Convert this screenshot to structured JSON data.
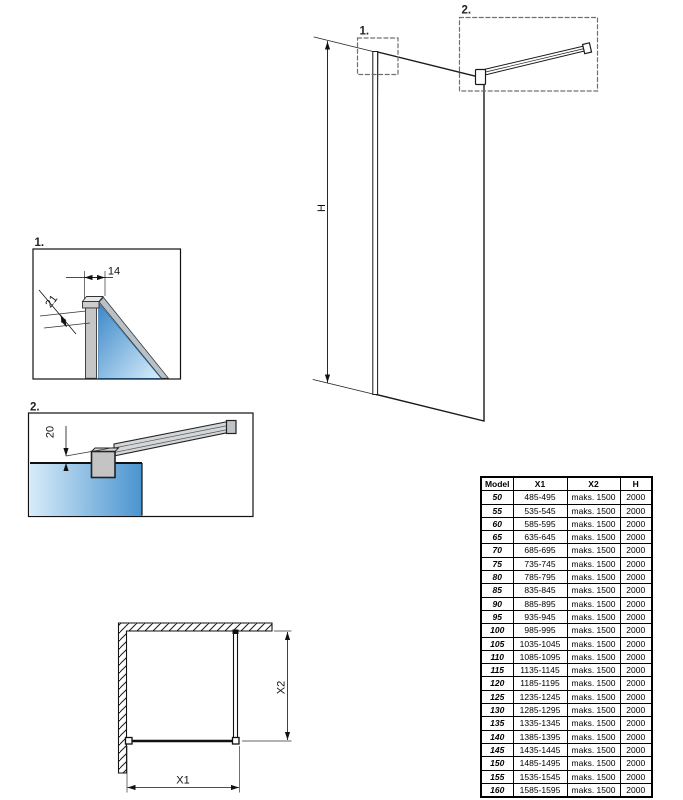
{
  "drawing": {
    "callout_1": "1.",
    "callout_2": "2.",
    "dim_height": "H",
    "dim_width": "X1",
    "dim_depth": "X2",
    "dim_profile_width": "14",
    "dim_profile_depth": "21",
    "dim_bar_offset": "20"
  },
  "colors": {
    "line": "#1a1a1a",
    "dash_gray": "#707070",
    "metal_gray": "#c6c6c6",
    "glass_blue_dark": "#3b87c9",
    "glass_blue_light": "#d9eefb"
  },
  "table": {
    "headers": [
      "Model",
      "X1",
      "X2",
      "H"
    ],
    "rows": [
      [
        "50",
        "485-495",
        "maks. 1500",
        "2000"
      ],
      [
        "55",
        "535-545",
        "maks. 1500",
        "2000"
      ],
      [
        "60",
        "585-595",
        "maks. 1500",
        "2000"
      ],
      [
        "65",
        "635-645",
        "maks. 1500",
        "2000"
      ],
      [
        "70",
        "685-695",
        "maks. 1500",
        "2000"
      ],
      [
        "75",
        "735-745",
        "maks. 1500",
        "2000"
      ],
      [
        "80",
        "785-795",
        "maks. 1500",
        "2000"
      ],
      [
        "85",
        "835-845",
        "maks. 1500",
        "2000"
      ],
      [
        "90",
        "885-895",
        "maks. 1500",
        "2000"
      ],
      [
        "95",
        "935-945",
        "maks. 1500",
        "2000"
      ],
      [
        "100",
        "985-995",
        "maks. 1500",
        "2000"
      ],
      [
        "105",
        "1035-1045",
        "maks. 1500",
        "2000"
      ],
      [
        "110",
        "1085-1095",
        "maks. 1500",
        "2000"
      ],
      [
        "115",
        "1135-1145",
        "maks. 1500",
        "2000"
      ],
      [
        "120",
        "1185-1195",
        "maks. 1500",
        "2000"
      ],
      [
        "125",
        "1235-1245",
        "maks. 1500",
        "2000"
      ],
      [
        "130",
        "1285-1295",
        "maks. 1500",
        "2000"
      ],
      [
        "135",
        "1335-1345",
        "maks. 1500",
        "2000"
      ],
      [
        "140",
        "1385-1395",
        "maks. 1500",
        "2000"
      ],
      [
        "145",
        "1435-1445",
        "maks. 1500",
        "2000"
      ],
      [
        "150",
        "1485-1495",
        "maks. 1500",
        "2000"
      ],
      [
        "155",
        "1535-1545",
        "maks. 1500",
        "2000"
      ],
      [
        "160",
        "1585-1595",
        "maks. 1500",
        "2000"
      ]
    ]
  }
}
